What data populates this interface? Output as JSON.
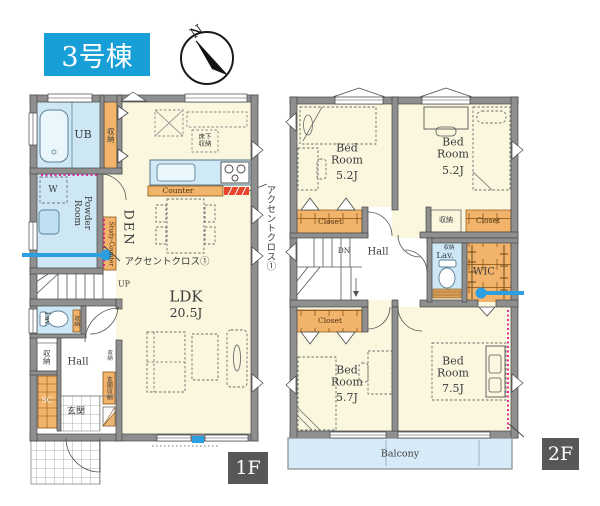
{
  "title_badge": {
    "label": "3号棟"
  },
  "compass": {
    "north": "N"
  },
  "colors": {
    "badge_blue": "#189FD8",
    "annotation_blue": "#2B9FE0",
    "accent_magenta": "#E0189B",
    "accent_red": "#E8442A",
    "closet_orange": "#F2B36B",
    "water_blue": "#CDE7F5"
  },
  "floor1": {
    "floor_label": "1F",
    "rooms": {
      "ub": "UB",
      "washer": "W",
      "powder_room": "Powder Room",
      "den": "DEN",
      "ldk_name": "LDK",
      "ldk_size": "20.5J",
      "lav": "Lav.",
      "hall": "Hall",
      "genkan": "玄関",
      "shoe_closet": "SC"
    },
    "features": {
      "storage": "収納",
      "study_counter": "Study-Counter",
      "counter": "Counter",
      "floor_storage": "床下収納",
      "genkan_storage": "玄関収納",
      "up": "UP",
      "accent_cross_1": "アクセントクロス①"
    }
  },
  "floor2": {
    "floor_label": "2F",
    "rooms": {
      "bedroom1": {
        "name": "Bed Room",
        "size": "5.2J"
      },
      "bedroom2": {
        "name": "Bed Room",
        "size": "5.2J"
      },
      "bedroom3": {
        "name": "Bed Room",
        "size": "5.7J"
      },
      "bedroom4": {
        "name": "Bed Room",
        "size": "7.5J"
      },
      "hall": "Hall",
      "lav": "Lav.",
      "wic": "WIC",
      "balcony": "Balcony"
    },
    "features": {
      "closet": "Closet",
      "storage": "収納",
      "down": "DN"
    }
  }
}
